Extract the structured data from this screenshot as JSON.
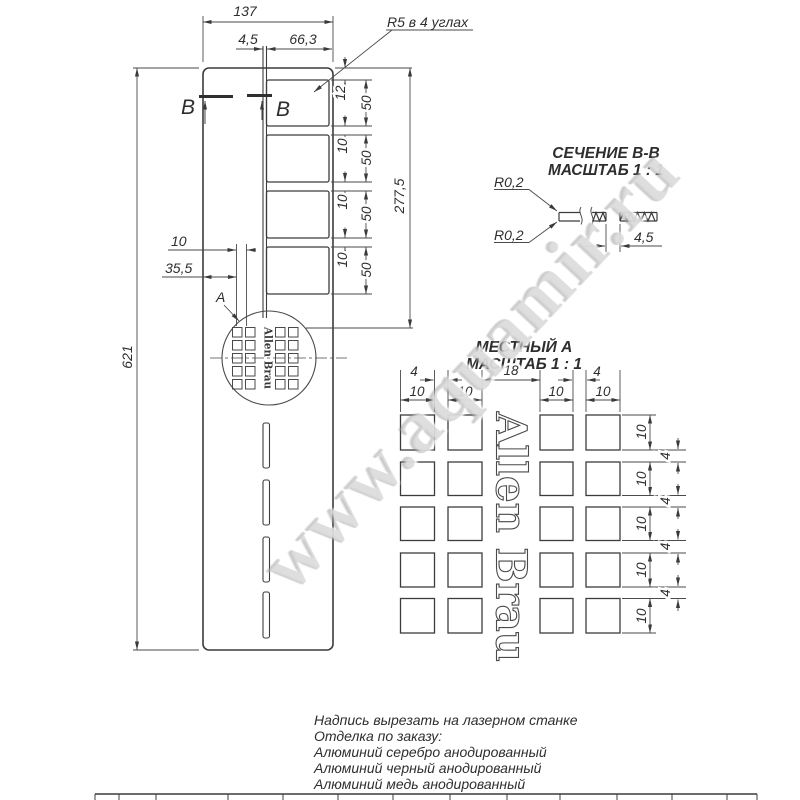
{
  "watermark": "www.aquamir.ru",
  "main_view": {
    "dim_overall_width": "137",
    "dim_slot_width": "4,5",
    "dim_window_width": "66,3",
    "corner_radius_note": "R5 в 4 углах",
    "section_label_left": "В",
    "section_label_right": "В",
    "dim_overall_height": "621",
    "dim_top_offset": "12",
    "window_heights": [
      "50",
      "50",
      "50",
      "50"
    ],
    "window_gaps": [
      "10",
      "10",
      "10"
    ],
    "dim_windows_span": "277,5",
    "dim_pattern_offset": "10",
    "dim_pattern_left": "35,5",
    "detail_ref": "A"
  },
  "section_view": {
    "title": "СЕЧЕНИЕ В-В",
    "scale": "МАСШТАБ 1 : 1",
    "radius_top": "R0,2",
    "radius_bottom": "R0,2",
    "dim_slot_width": "4,5"
  },
  "detail_view": {
    "title": "МЕСТНЫЙ А",
    "scale": "МАСШТАБ 1 : 1",
    "brand": "Allen Brau",
    "top_gap_dims": [
      "4",
      "18",
      "4"
    ],
    "column_width_dims": [
      "10",
      "10",
      "10",
      "10"
    ],
    "row_height_dims": [
      "10",
      "10",
      "10",
      "10",
      "10"
    ],
    "row_gap_dims": [
      "4",
      "4",
      "4",
      "4"
    ]
  },
  "engraving": {
    "brand": "Allen Brau"
  },
  "notes": [
    "Надпись вырезать на лазерном станке",
    "Отделка по заказу:",
    "Алюминий серебро анодированный",
    "Алюминий черный анодированный",
    "Алюминий медь анодированный"
  ]
}
